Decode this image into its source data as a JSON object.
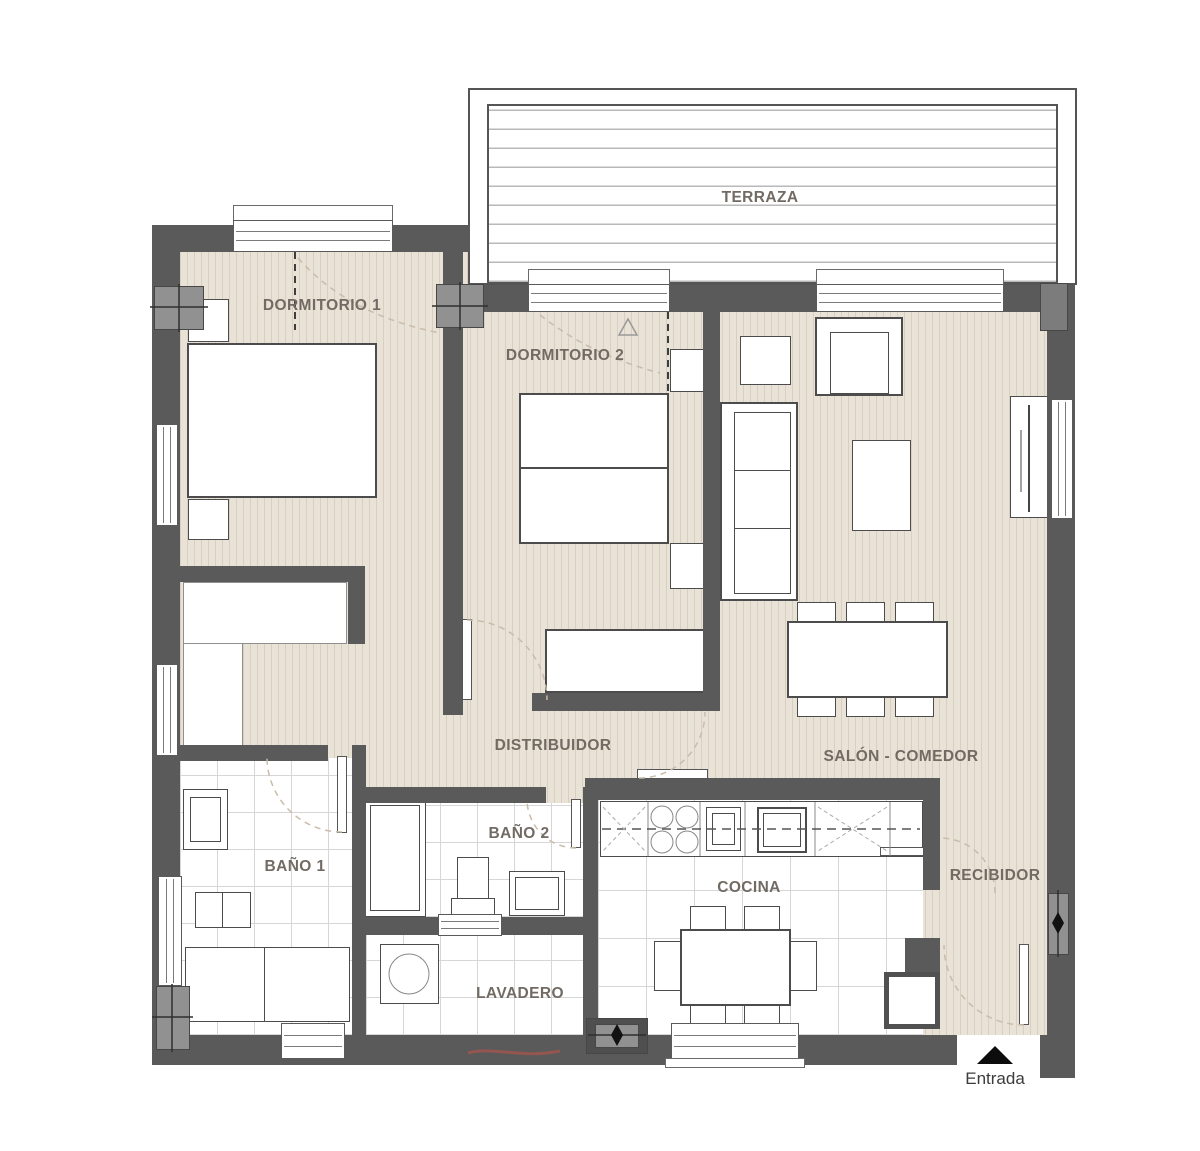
{
  "title": "Plano de vivienda - 2 dormitorios",
  "labels": {
    "terraza": "TERRAZA",
    "dormitorio1": "DORMITORIO 1",
    "dormitorio2": "DORMITORIO 2",
    "distribuidor": "DISTRIBUIDOR",
    "salon_comedor": "SALÓN - COMEDOR",
    "bano1": "BAÑO 1",
    "bano2": "BAÑO 2",
    "cocina": "COCINA",
    "lavadero": "LAVADERO",
    "recibidor": "RECIBIDOR",
    "entrada": "Entrada"
  },
  "colors": {
    "wall": "#5a5a5a",
    "column": "#919191",
    "floor": "#e9e2d6",
    "floor_stripe": "#d9cfc0",
    "tile_line": "#d6d6d6",
    "deck_line": "#b9b9b9",
    "label_text": "#716b64",
    "entrada_text": "#3c3c3c",
    "annotation_dash": "#c9bcaa",
    "red_mark": "#cc5148"
  }
}
